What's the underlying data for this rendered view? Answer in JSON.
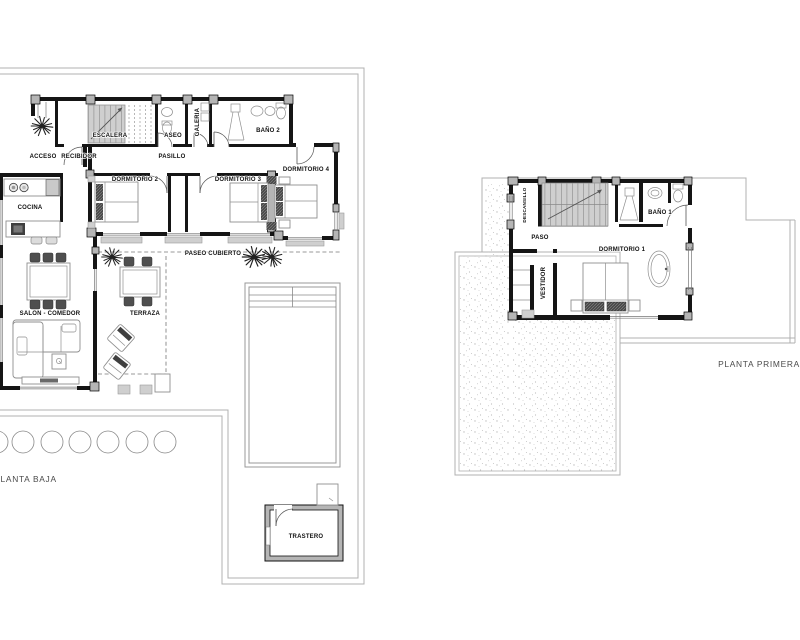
{
  "document": {
    "type": "architectural floor plan",
    "background": "#ffffff"
  },
  "ground_floor": {
    "caption": "PLANTA BAJA",
    "labels": {
      "acceso": "ACCESO",
      "recibidor": "RECIBIDOR",
      "escalera": "ESCALERA",
      "aseo": "ASEO",
      "galeria": "GALERIA",
      "bano2": "BAÑO 2",
      "pasillo": "PASILLO",
      "cocina": "COCINA",
      "dormitorio2": "DORMITORIO 2",
      "dormitorio3": "DORMITORIO 3",
      "dormitorio4": "DORMITORIO 4",
      "salon_comedor": "SALON - COMEDOR",
      "terraza": "TERRAZA",
      "paseo_cubierto": "PASEO CUBIERTO",
      "trastero": "TRASTERO"
    }
  },
  "first_floor": {
    "caption": "PLANTA PRIMERA",
    "labels": {
      "descansillo": "DESCANSILLO",
      "paso": "PASO",
      "vestidor": "VESTIDOR",
      "dormitorio1": "DORMITORIO 1",
      "bano1": "BAÑO 1"
    }
  },
  "colors": {
    "wall": "#151515",
    "pilaster": "#b5b5b5",
    "stair_fill": "#cfcfcf",
    "boundary": "#b0b0b0",
    "stipple_dot": "#bdbdbd",
    "furniture_stroke": "#8f8f8f",
    "dark_furniture": "#4f4f4f",
    "label_text": "#111111",
    "caption_text": "#4a4a4a",
    "dashed_line": "#777777",
    "pool_edge": "#999999",
    "background": "#ffffff"
  }
}
